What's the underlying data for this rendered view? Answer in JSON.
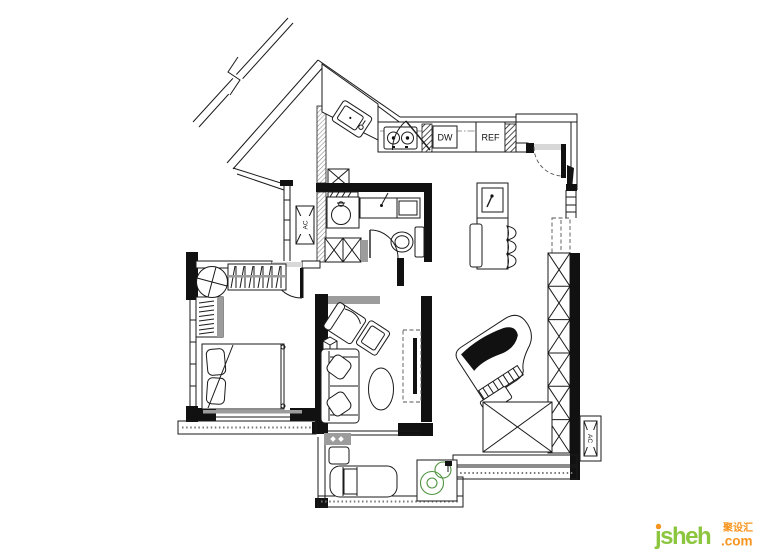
{
  "plan": {
    "labels": {
      "dishwasher": "DW",
      "refrigerator": "REF",
      "ac_unit_left": "AC",
      "ac_unit_right": "AC"
    },
    "colors": {
      "wall": "#111111",
      "line": "#1a1a1a",
      "gray_fixture": "#9c9c9c",
      "plant_green": "#4f9440"
    }
  },
  "watermark": {
    "brand": "jsheh",
    "brand_cn": "聚设汇",
    "tld": ".com",
    "brand_color": "#8CC63E",
    "accent_color": "#F7941E"
  }
}
